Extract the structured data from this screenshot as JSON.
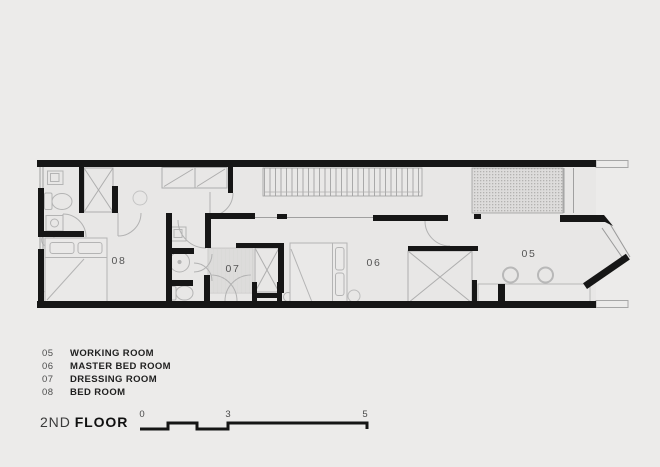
{
  "title": {
    "prefix": "2ND",
    "word": "FLOOR"
  },
  "legend": {
    "items": [
      {
        "code": "05",
        "name": "WORKING ROOM"
      },
      {
        "code": "06",
        "name": "MASTER BED ROOM"
      },
      {
        "code": "07",
        "name": "DRESSING ROOM"
      },
      {
        "code": "08",
        "name": "BED ROOM"
      }
    ]
  },
  "plan": {
    "room_labels": [
      {
        "text": "05"
      },
      {
        "text": "06"
      },
      {
        "text": "07"
      },
      {
        "text": "08"
      }
    ]
  },
  "scale_bar": {
    "ticks": [
      "0",
      "3",
      "5"
    ],
    "unit_note": ""
  },
  "colors": {
    "background": "#ecebea",
    "floor": "#e8e7e6",
    "wall": "#161616",
    "thin_line": "#a8a8a8",
    "furniture_line": "#b4b4b4",
    "label_text": "#545454"
  }
}
